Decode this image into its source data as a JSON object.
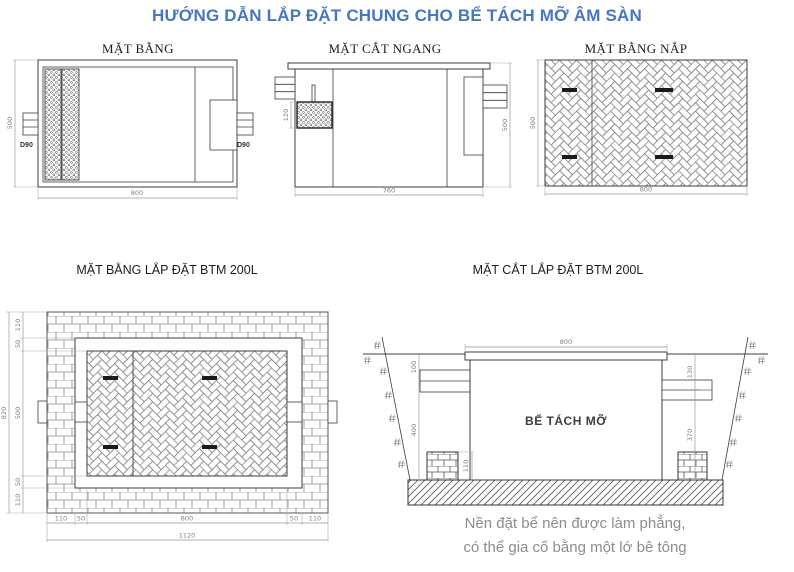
{
  "page": {
    "title": "HƯỚNG DẪN LẮP ĐẶT CHUNG CHO BỂ TÁCH MỠ ÂM SÀN"
  },
  "colors": {
    "title_blue": "#4576be",
    "caption_gray": "#8c8c8c",
    "line_dark": "#3c3c3c",
    "dim_gray": "#808080"
  },
  "drawings": {
    "plan": {
      "title": "MẶT BẰNG",
      "dims": {
        "height_left": "500",
        "width_bottom": "800",
        "inlet_label": "D90",
        "outlet_label": "D90"
      }
    },
    "cross_section": {
      "title": "MẶT CẮT NGANG",
      "dims": {
        "basket_height": "120",
        "height_right": "500",
        "width_bottom": "760"
      }
    },
    "lid_plan": {
      "title": "MẶT BẰNG NẮP",
      "dims": {
        "height_left": "500",
        "width_bottom": "800"
      }
    },
    "install_plan": {
      "title": "MẶT BẰNG LẮP ĐẶT BTM 200L",
      "dims": {
        "left_total": "820",
        "left_chain": [
          "110",
          "50",
          "500",
          "50",
          "110"
        ],
        "bottom_chain": [
          "110",
          "50",
          "800",
          "50",
          "110"
        ],
        "bottom_total": "1120"
      }
    },
    "install_section": {
      "title": "MẶT CẮT LẮP ĐẶT BTM 200L",
      "tank_label": "BỂ TÁCH MỠ",
      "dims": {
        "lid_width": "800",
        "ground_to_inlet": "100",
        "inlet_to_base": "400",
        "support_height": "110",
        "ground_to_outlet": "130",
        "outlet_to_base": "370"
      }
    }
  },
  "note": {
    "line1": "Nền đặt bể nên được làm phẳng,",
    "line2": "có thể gia cố bằng một lớ bê tông"
  }
}
